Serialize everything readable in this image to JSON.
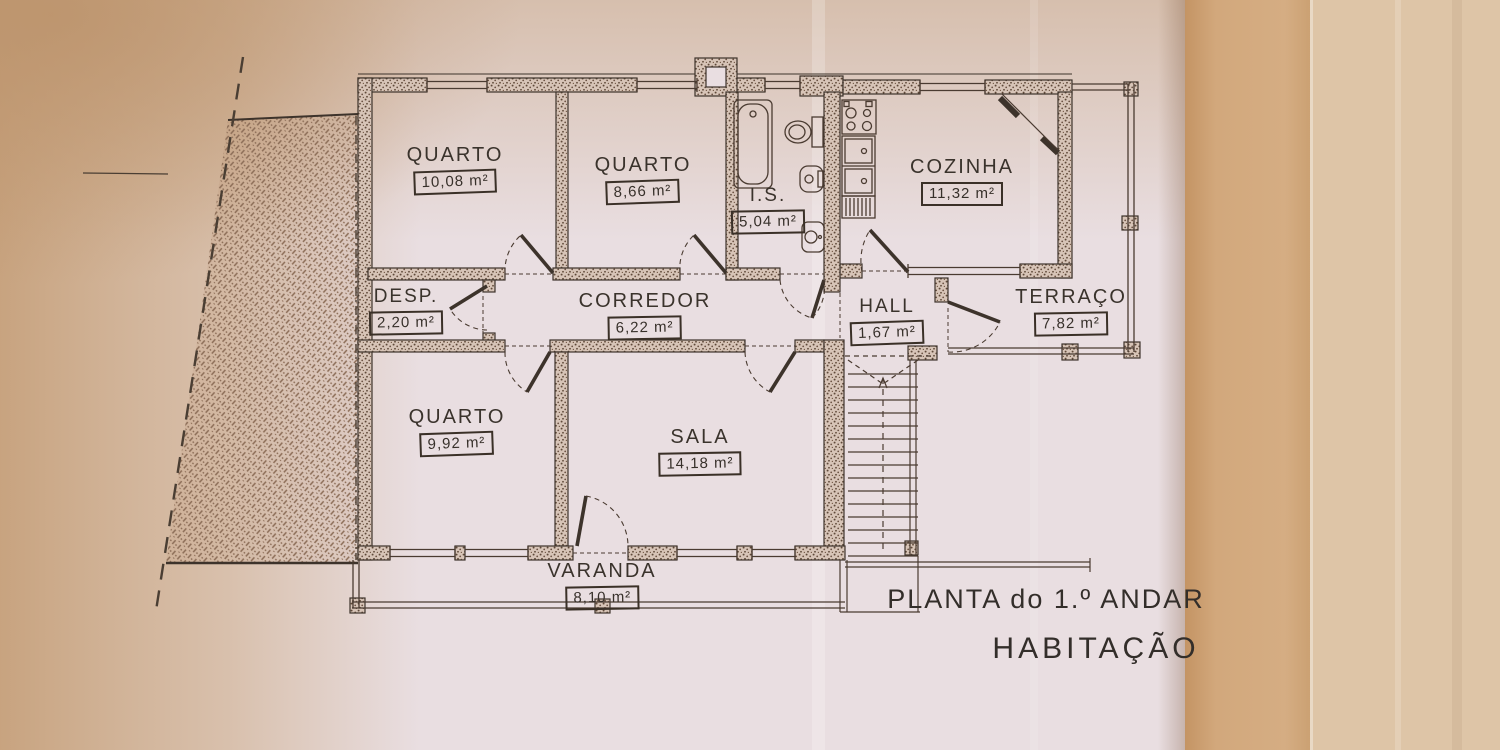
{
  "document": {
    "type": "architectural floor plan (photo of printed drawing)",
    "title": "PLANTA do 1.º ANDAR",
    "subtitle": "HABITAÇÃO"
  },
  "rooms": [
    {
      "id": "quarto-1",
      "name": "QUARTO",
      "area": "10,08 m²"
    },
    {
      "id": "quarto-2",
      "name": "QUARTO",
      "area": "8,66 m²"
    },
    {
      "id": "is",
      "name": "I.S.",
      "area": "5,04 m²"
    },
    {
      "id": "cozinha",
      "name": "COZINHA",
      "area": "11,32 m²"
    },
    {
      "id": "desp",
      "name": "DESP.",
      "area": "2,20 m²"
    },
    {
      "id": "corredor",
      "name": "CORREDOR",
      "area": "6,22 m²"
    },
    {
      "id": "hall",
      "name": "HALL",
      "area": "1,67 m²"
    },
    {
      "id": "terraco",
      "name": "TERRAÇO",
      "area": "7,82 m²"
    },
    {
      "id": "quarto-3",
      "name": "QUARTO",
      "area": "9,92 m²"
    },
    {
      "id": "sala",
      "name": "SALA",
      "area": "14,18 m²"
    },
    {
      "id": "varanda",
      "name": "VARANDA",
      "area": "8,10 m²"
    }
  ],
  "colors": {
    "paper": "#e9dee1",
    "ink": "#3d332b",
    "wall_speckle": "#5f4939",
    "hatch": "#8b6c56",
    "fold_band_dark": "#cda176",
    "fold_band_light": "#dec5a7"
  }
}
